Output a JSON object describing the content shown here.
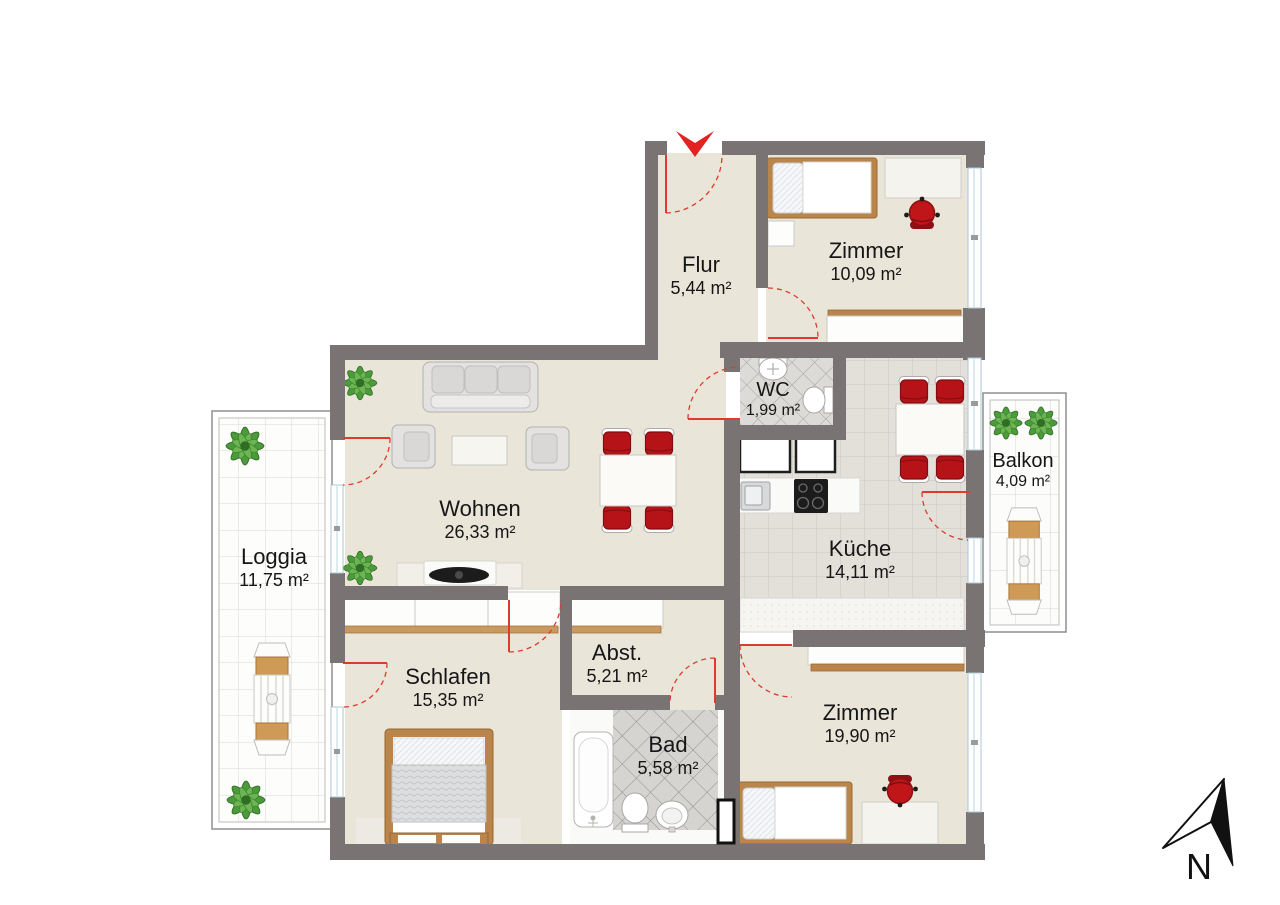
{
  "plan": {
    "type": "floor-plan",
    "rooms": [
      {
        "id": "flur",
        "name": "Flur",
        "area": "5,44 m²"
      },
      {
        "id": "zimmer-oben",
        "name": "Zimmer",
        "area": "10,09 m²"
      },
      {
        "id": "wc",
        "name": "WC",
        "area": "1,99 m²"
      },
      {
        "id": "kueche",
        "name": "Küche",
        "area": "14,11 m²"
      },
      {
        "id": "balkon",
        "name": "Balkon",
        "area": "4,09 m²"
      },
      {
        "id": "wohnen",
        "name": "Wohnen",
        "area": "26,33 m²"
      },
      {
        "id": "loggia",
        "name": "Loggia",
        "area": "11,75 m²"
      },
      {
        "id": "schlafen",
        "name": "Schlafen",
        "area": "15,35 m²"
      },
      {
        "id": "abstellraum",
        "name": "Abst.",
        "area": "5,21 m²"
      },
      {
        "id": "bad",
        "name": "Bad",
        "area": "5,58 m²"
      },
      {
        "id": "zimmer-unten",
        "name": "Zimmer",
        "area": "19,90 m²"
      }
    ],
    "compass": {
      "label": "N"
    },
    "icons": {
      "entrance": "red-entrance-arrow",
      "north": "north-arrow"
    },
    "palette": {
      "wall": "#7a7374",
      "floor": "#eae5d9",
      "kitchen_tile": "#e3e0da",
      "bath_tile": "#d6d4d1",
      "outdoor_tile": "#fdfdfc",
      "chair_red": "#b61319",
      "door_red": "#de3a2e",
      "wood": "#b9854a"
    }
  }
}
